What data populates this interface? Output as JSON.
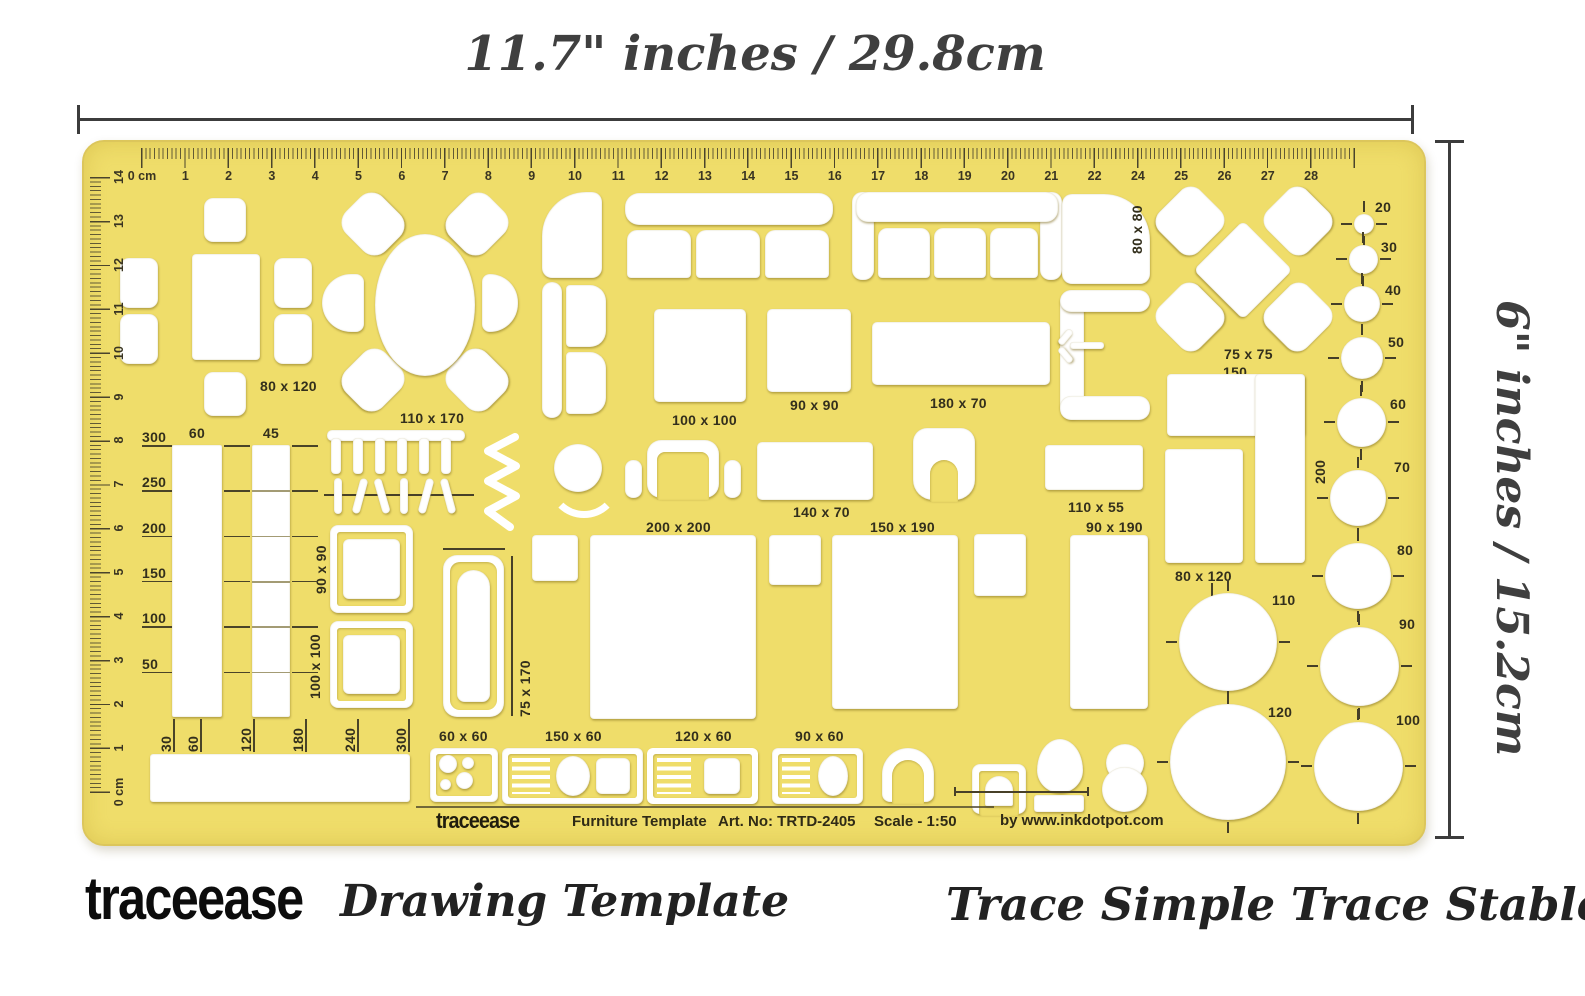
{
  "annotations": {
    "width_label": "11.7\" inches / 29.8cm",
    "height_label": "6\" inches / 15.2cm"
  },
  "branding": {
    "logo": "traceease",
    "subtitle": "Drawing Template",
    "tagline": "Trace Simple Trace Stable"
  },
  "template_footer": {
    "logo": "traceease",
    "product": "Furniture Template",
    "art_no": "Art. No: TRTD-2405",
    "scale": "Scale - 1:50",
    "credit": "by www.inkdotpot.com"
  },
  "rulers": {
    "top_labels": [
      "0 cm",
      "1",
      "2",
      "3",
      "4",
      "5",
      "6",
      "7",
      "8",
      "9",
      "10",
      "11",
      "12",
      "13",
      "14",
      "15",
      "16",
      "17",
      "18",
      "19",
      "20",
      "21",
      "22",
      "24",
      "25",
      "26",
      "27",
      "28",
      ""
    ],
    "left_labels": [
      "14",
      "13",
      "12",
      "11",
      "10",
      "9",
      "8",
      "7",
      "6",
      "5",
      "4",
      "3",
      "2",
      "1",
      "0 cm"
    ]
  },
  "circle_labels": [
    "20",
    "30",
    "40",
    "50",
    "60",
    "70",
    "80",
    "90",
    "100",
    "110",
    "120"
  ],
  "left_scale": {
    "side": [
      "300",
      "250",
      "200",
      "150",
      "100",
      "50"
    ],
    "top": [
      "60",
      "45"
    ],
    "bottom": [
      "30",
      "60",
      "120",
      "180",
      "240",
      "300"
    ]
  },
  "shape_labels": {
    "dining_table": "80 x 120",
    "oval_table": "110 x 170",
    "square_table_100": "100 x 100",
    "square_table_90": "90 x 90",
    "rect_180_70": "180 x 70",
    "corner_80_80": "80 x 80",
    "diamond_table": "75 x 75",
    "kitchen_150": "150",
    "kitchen_80_120": "80 x 120",
    "rot_200": "200",
    "bed_200_200": "200 x 200",
    "rect_140_70": "140 x 70",
    "bed_150_190": "150 x 190",
    "rect_110_55": "110 x 55",
    "bed_90_190": "90 x 190",
    "wardrobe_90_90": "90 x 90",
    "wardrobe_100_100": "100 x 100",
    "bathtub_75_170": "75 x 170",
    "stove_60_60": "60 x 60",
    "sink_150_60": "150 x 60",
    "sink_120_60": "120 x 60",
    "sink_90_60": "90 x 60"
  },
  "colors": {
    "template_yellow": "#EFDD6A",
    "cutout_white": "#FFFFFF",
    "printed_ink": "#332F1C",
    "annotation_ink": "#3F3F3F",
    "brand_ink": "#0C0C0C"
  }
}
